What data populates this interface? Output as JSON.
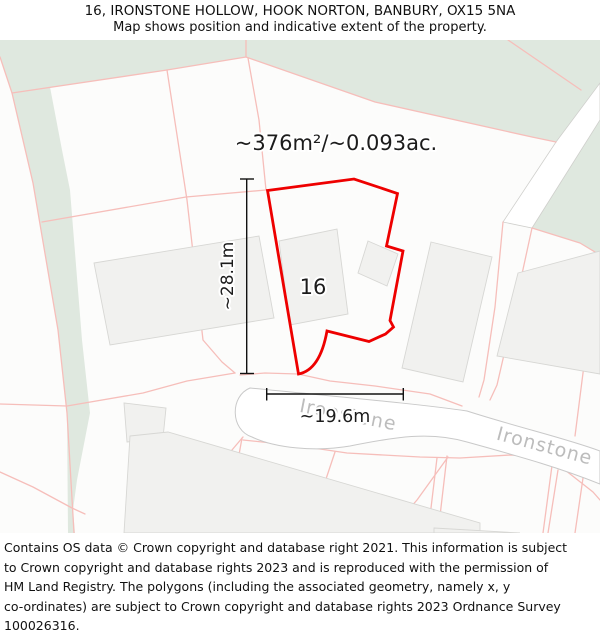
{
  "header": {
    "title": "16, IRONSTONE HOLLOW, HOOK NORTON, BANBURY, OX15 5NA",
    "subtitle": "Map shows position and indicative extent of the property."
  },
  "map": {
    "area_label": "~376m²/~0.093ac.",
    "property_number": "16",
    "dimensions": {
      "height": "~28.1m",
      "width": "~19.6m"
    },
    "road_labels": [
      "Ironstone",
      "Ironstone"
    ],
    "colors": {
      "property_outline": "#ee0000",
      "greenspace": "#dfe8df",
      "parcel_line": "#f6beba",
      "building_fill": "#f1f1ef",
      "building_stroke": "#d7d7d4",
      "road_fill": "#ffffff",
      "road_stroke": "#c9c9c9",
      "dimension_line": "#111111",
      "road_label_color": "#bcbcbc",
      "label_color": "#1c1c1c"
    }
  },
  "footer": {
    "lines": [
      "Contains OS data © Crown copyright and database right 2021. This information is subject",
      "to Crown copyright and database rights 2023 and is reproduced with the permission of",
      "HM Land Registry. The polygons (including the associated geometry, namely x, y",
      "co-ordinates) are subject to Crown copyright and database rights 2023 Ordnance Survey",
      "100026316."
    ]
  }
}
